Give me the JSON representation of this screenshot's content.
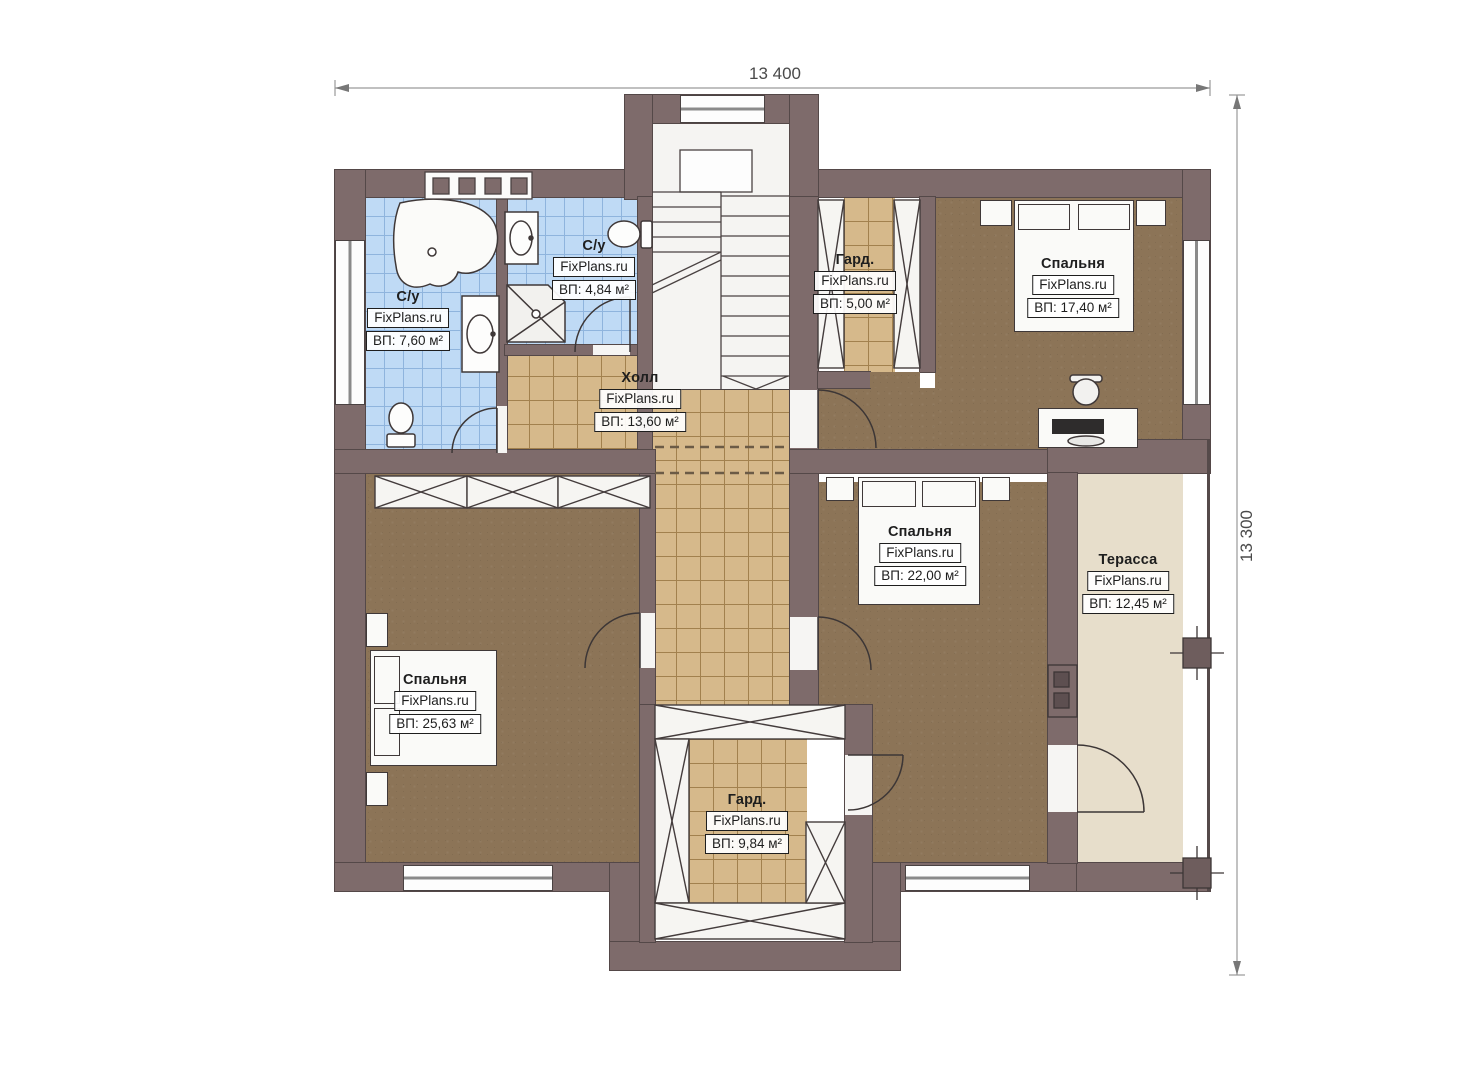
{
  "dimensions": {
    "top": "13 400",
    "right": "13 300"
  },
  "rooms": [
    {
      "id": "bathroom-1",
      "name": "С/у",
      "watermark": "FixPlans.ru",
      "area": "ВП: 7,60 м²"
    },
    {
      "id": "bathroom-2",
      "name": "С/у",
      "watermark": "FixPlans.ru",
      "area": "ВП: 4,84 м²"
    },
    {
      "id": "hall",
      "name": "Холл",
      "watermark": "FixPlans.ru",
      "area": "ВП: 13,60 м²"
    },
    {
      "id": "wardrobe-1",
      "name": "Гард.",
      "watermark": "FixPlans.ru",
      "area": "ВП: 5,00 м²"
    },
    {
      "id": "bedroom-1",
      "name": "Спальня",
      "watermark": "FixPlans.ru",
      "area": "ВП: 17,40 м²"
    },
    {
      "id": "bedroom-2",
      "name": "Спальня",
      "watermark": "FixPlans.ru",
      "area": "ВП: 22,00 м²"
    },
    {
      "id": "bedroom-3",
      "name": "Спальня",
      "watermark": "FixPlans.ru",
      "area": "ВП: 25,63 м²"
    },
    {
      "id": "wardrobe-2",
      "name": "Гард.",
      "watermark": "FixPlans.ru",
      "area": "ВП: 9,84 м²"
    },
    {
      "id": "terrace",
      "name": "Терасса",
      "watermark": "FixPlans.ru",
      "area": "ВП: 12,45 м²"
    }
  ],
  "colors": {
    "wall": "#7e6b6b",
    "bathroom_tile": "#bfdaf5",
    "hall_tile": "#d6b98b",
    "bedroom_floor": "#8c7457",
    "terrace_floor": "#e7decb"
  }
}
